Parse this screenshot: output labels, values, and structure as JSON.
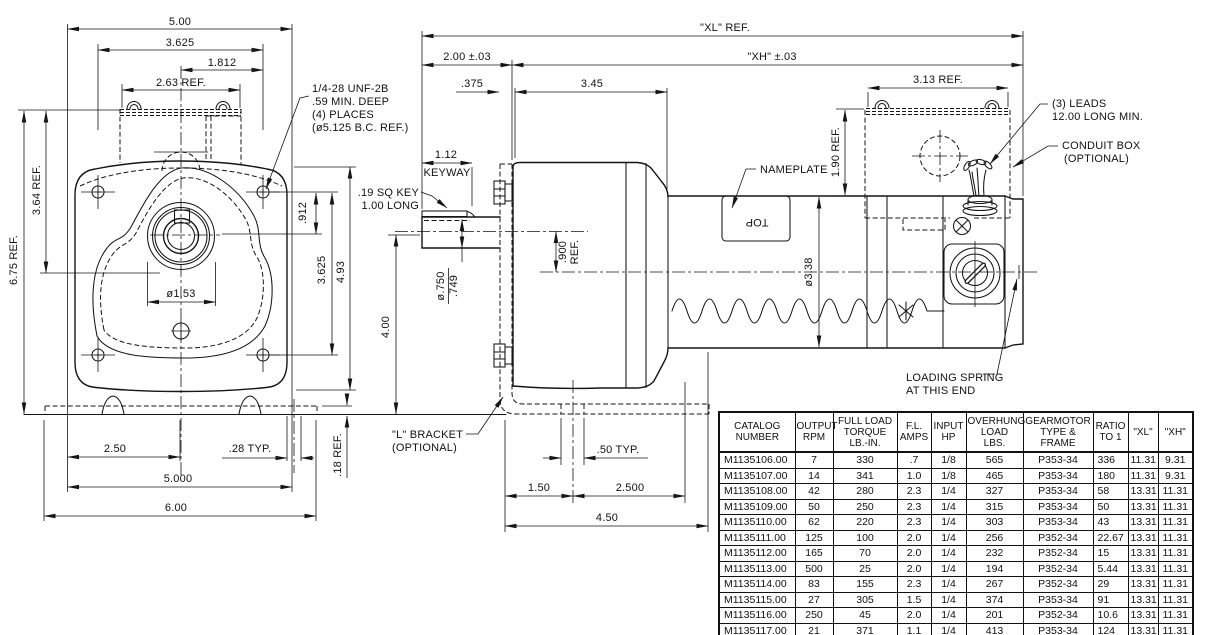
{
  "drawing": {
    "front": {
      "d500": "5.00",
      "d3625": "3.625",
      "d1812": "1.812",
      "d263": "2.63  REF.",
      "note1": "1/4-28 UNF-2B",
      "note2": ".59 MIN. DEEP",
      "note3": "(4) PLACES",
      "note4": "(ø5.125 B.C. REF.)",
      "d675": "6.75 REF.",
      "d364": "3.64  REF.",
      "d912": ".912",
      "d3625v": "3.625",
      "d493": "4.93",
      "d153": "ø1.53",
      "d250": "2.50",
      "d28": ".28  TYP.",
      "d5000": "5.000",
      "d600": "6.00",
      "d18": ".18  REF."
    },
    "side": {
      "xl": "\"XL\" REF.",
      "xh": "\"XH\" ±.03",
      "d200": "2.00 ±.03",
      "d375": ".375",
      "d345": "3.45",
      "d112": "1.12",
      "keyway": "KEYWAY",
      "sqkey1": ".19 SQ KEY",
      "sqkey2": "1.00 LONG",
      "d750": "ø.750",
      "d749": ".749",
      "d900": ".900",
      "d900r": "REF.",
      "d400": "4.00",
      "d313": "3.13  REF.",
      "d190": "1.90 REF.",
      "nameplate": "NAMEPLATE",
      "top": "TOP",
      "leads1": "(3) LEADS",
      "leads2": "12.00 LONG MIN.",
      "conduit1": "CONDUIT BOX",
      "conduit2": "(OPTIONAL)",
      "d338": "ø3.38",
      "spring1": "LOADING SPRING",
      "spring2": "AT THIS END",
      "bracket1": "\"L\" BRACKET",
      "bracket2": "(OPTIONAL)",
      "d150": "1.50",
      "d2500": "2.500",
      "d450": "4.50",
      "d50": ".50  TYP."
    }
  },
  "table": {
    "headers": [
      "CATALOG\nNUMBER",
      "OUTPUT\nRPM",
      "FULL LOAD\nTORQUE\nLB.-IN.",
      "F.L.\nAMPS",
      "INPUT\nHP",
      "OVERHUNG\nLOAD\nLBS.",
      "GEARMOTOR\nTYPE &\nFRAME",
      "RATIO\nTO 1",
      "\"XL\"",
      "\"XH\""
    ],
    "col_widths": [
      76,
      38,
      64,
      34,
      35,
      57,
      70,
      35,
      30,
      35
    ],
    "rows": [
      [
        "M1135106.00",
        "7",
        "330",
        ".7",
        "1/8",
        "565",
        "P353-34",
        "336",
        "11.31",
        "9.31"
      ],
      [
        "M1135107.00",
        "14",
        "341",
        "1.0",
        "1/8",
        "465",
        "P353-34",
        "180",
        "11.31",
        "9.31"
      ],
      [
        "M1135108.00",
        "42",
        "280",
        "2.3",
        "1/4",
        "327",
        "P353-34",
        "58",
        "13.31",
        "11.31"
      ],
      [
        "M1135109.00",
        "50",
        "250",
        "2.3",
        "1/4",
        "315",
        "P353-34",
        "50",
        "13.31",
        "11.31"
      ],
      [
        "M1135110.00",
        "62",
        "220",
        "2.3",
        "1/4",
        "303",
        "P353-34",
        "43",
        "13.31",
        "11.31"
      ],
      [
        "M1135111.00",
        "125",
        "100",
        "2.0",
        "1/4",
        "256",
        "P352-34",
        "22.67",
        "13.31",
        "11.31"
      ],
      [
        "M1135112.00",
        "165",
        "70",
        "2.0",
        "1/4",
        "232",
        "P352-34",
        "15",
        "13.31",
        "11.31"
      ],
      [
        "M1135113.00",
        "500",
        "25",
        "2.0",
        "1/4",
        "194",
        "P352-34",
        "5.44",
        "13.31",
        "11.31"
      ],
      [
        "M1135114.00",
        "83",
        "155",
        "2.3",
        "1/4",
        "267",
        "P352-34",
        "29",
        "13.31",
        "11.31"
      ],
      [
        "M1135115.00",
        "27",
        "305",
        "1.5",
        "1/4",
        "374",
        "P353-34",
        "91",
        "13.31",
        "11.31"
      ],
      [
        "M1135116.00",
        "250",
        "45",
        "2.0",
        "1/4",
        "201",
        "P352-34",
        "10.6",
        "13.31",
        "11.31"
      ],
      [
        "M1135117.00",
        "21",
        "371",
        "1.1",
        "1/4",
        "413",
        "P353-34",
        "124",
        "13.31",
        "11.31"
      ]
    ]
  }
}
